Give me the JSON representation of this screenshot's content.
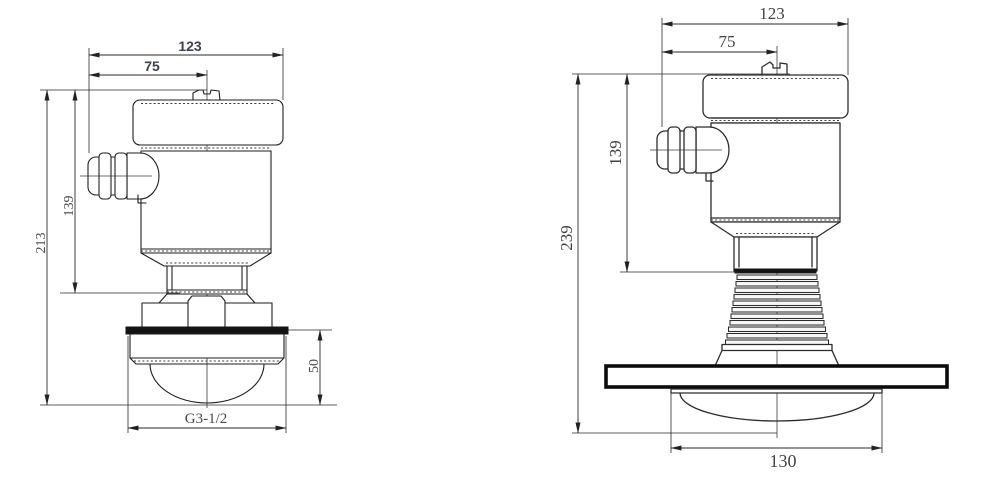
{
  "colors": {
    "background": "#ffffff",
    "outline_left": "#1e1e1e",
    "outline_right": "#2c2c2c",
    "dimension_lines": "#2a2a2a",
    "dim_text_sans": "#3a4150",
    "dim_text_serif": "#474747",
    "flange_band_fill": "#141414",
    "flange_plate_border": "#0c0c0c"
  },
  "left_drawing": {
    "description": "threaded radar level sensor, front view",
    "dim_width_overall": "123",
    "dim_width_to_center": "75",
    "dim_height_overall": "213",
    "dim_height_housing": "139",
    "dim_antenna_height": "50",
    "dim_thread_size": "G3-1/2"
  },
  "right_drawing": {
    "description": "flanged radar level sensor, front view",
    "dim_width_overall": "123",
    "dim_width_to_center": "75",
    "dim_height_overall": "239",
    "dim_height_housing": "139",
    "dim_antenna_width": "130"
  }
}
